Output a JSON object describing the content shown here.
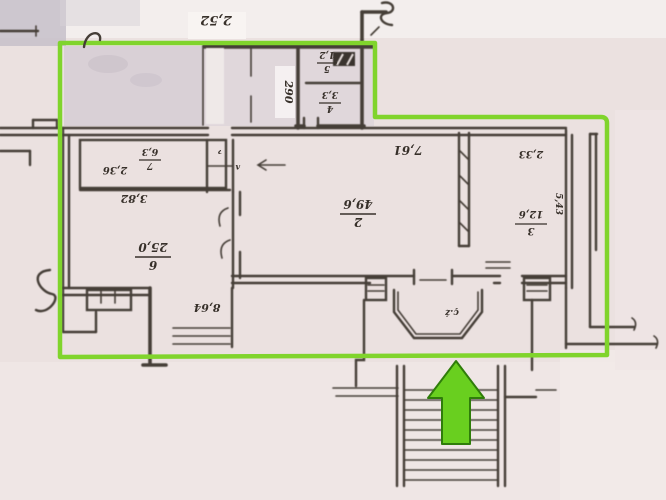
{
  "plan": {
    "rooms": [
      {
        "number": "2",
        "area": "49,6"
      },
      {
        "number": "3",
        "area": "12,6"
      },
      {
        "number": "4",
        "area": "3,3"
      },
      {
        "number": "5",
        "area": "1,2"
      },
      {
        "number": "6",
        "area": "25,0"
      },
      {
        "number": "7",
        "area": "6,3"
      }
    ],
    "dimensions": {
      "top": "2,52",
      "vertical": "290",
      "room7": "2,36",
      "room6_width": "3,82",
      "hall_width": "7,61",
      "room3_width": "2,33",
      "room3_depth": "5,43",
      "bottom": "8,64"
    },
    "annotations": {
      "bay": "ç.ż",
      "closet_a": "ʌ",
      "closet_b": "ɂ"
    },
    "colors": {
      "highlight": "#80d42c",
      "arrow_fill": "#69cf1f",
      "arrow_stroke": "#2f7d0a"
    }
  }
}
